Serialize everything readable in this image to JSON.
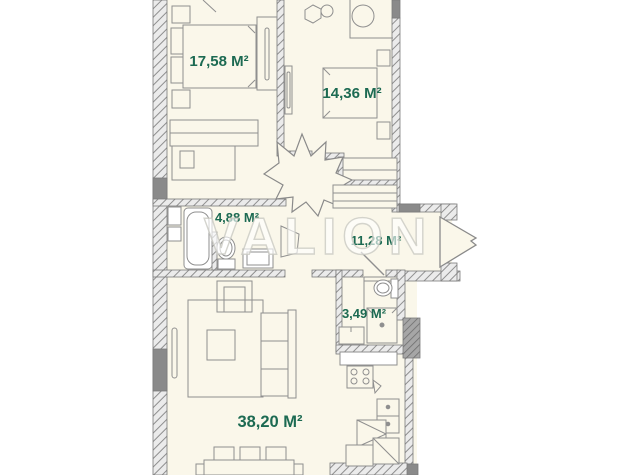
{
  "watermark": "VALION",
  "plan_title": "apartment-floor-plan",
  "colors": {
    "label_green": "#1c6a52",
    "room_fill": "#faf7ea",
    "wall_dark": "#8a8a8a",
    "line_gray": "#8f8f8f"
  },
  "rooms": [
    {
      "id": "bedroom-1",
      "area_label": "17,58 M²"
    },
    {
      "id": "bedroom-2",
      "area_label": "14,36 M²"
    },
    {
      "id": "bathroom",
      "area_label": "4,88 M²"
    },
    {
      "id": "hallway",
      "area_label": "11,28 M²"
    },
    {
      "id": "wc",
      "area_label": "3,49 M²"
    },
    {
      "id": "living-kitchen",
      "area_label": "38,20 M²"
    }
  ]
}
